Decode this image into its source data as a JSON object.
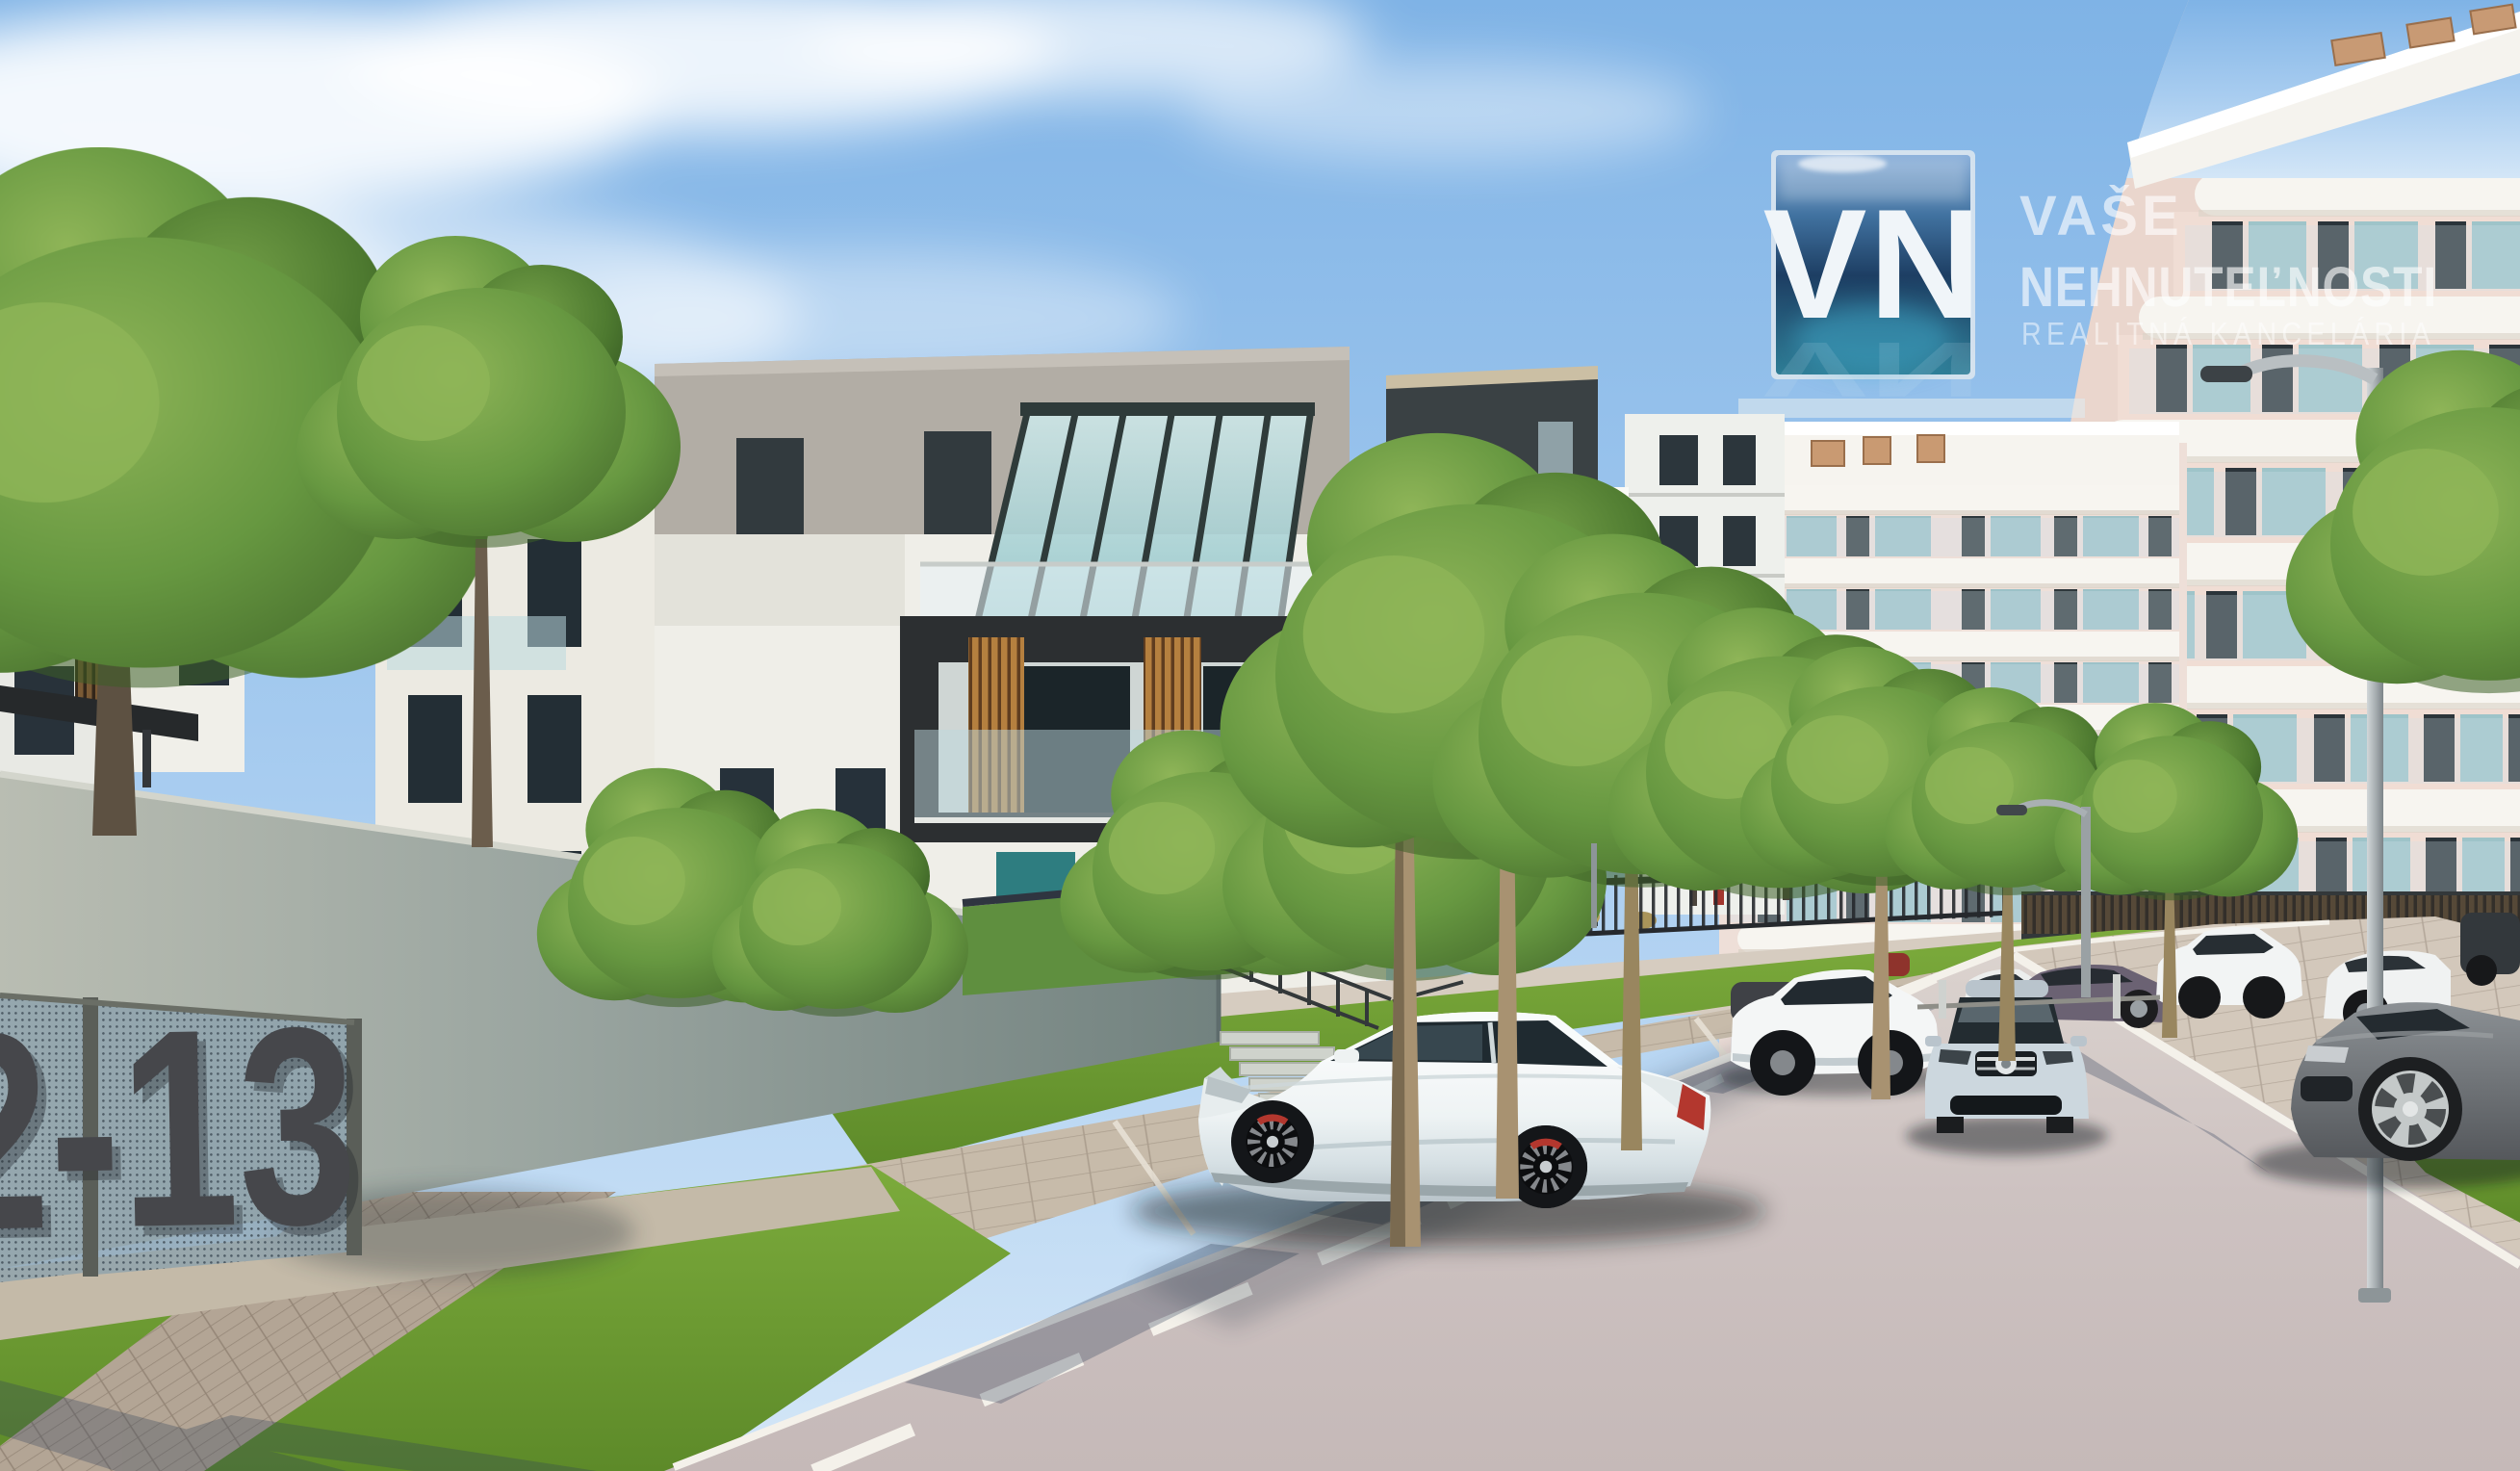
{
  "watermark": {
    "logo_text": "VN",
    "line1": "VAŠE",
    "line2": "NEHNUTEĽNOSTI",
    "line3": "REALITNÁ KANCELÁRIA"
  },
  "wall_sign": {
    "text": "2-13"
  },
  "scene": {
    "type": "architectural-exterior-render",
    "elements": [
      "sky",
      "clouds",
      "apartment-buildings",
      "rooftop-glass-canopies",
      "wood-slat-balconies",
      "residential-towers",
      "concrete-retaining-wall",
      "perforated-sign-panels",
      "street",
      "lane-markings",
      "parked-cars",
      "driving-car",
      "street-trees",
      "street-lamps",
      "metal-fence",
      "stairs",
      "lawn",
      "paved-walkways"
    ]
  },
  "colors": {
    "sky_top": "#7fb3e6",
    "sky_mid": "#a9cdf0",
    "sky_horizon": "#d3e6f7",
    "facade_white": "#efeee8",
    "penthouse_gray": "#b2ada5",
    "charcoal": "#34383a",
    "wood": "#b5803f",
    "glass_teal": "#8fc3c7",
    "window_dark": "#26313a",
    "tower_pink": "#eedfd8",
    "tower_band": "#f7f5f0",
    "grass": "#74a437",
    "wall_concrete": "#9aa5a0",
    "mesh_panel": "#8aa0ad",
    "sign_number": "#46474b",
    "road": "#cdc2c1",
    "road_line": "#f4f1ea",
    "paver": "#c7bbaa",
    "car_white": "#f4f6f6",
    "car_silver": "#ccd7de",
    "tree_green": "#679841",
    "trunk": "#a89271",
    "lamp_gray": "#a9b0b3",
    "logo_navy": "#1d3e63",
    "logo_teal": "#3fa9c9",
    "watermark_text": "#ffffff"
  }
}
